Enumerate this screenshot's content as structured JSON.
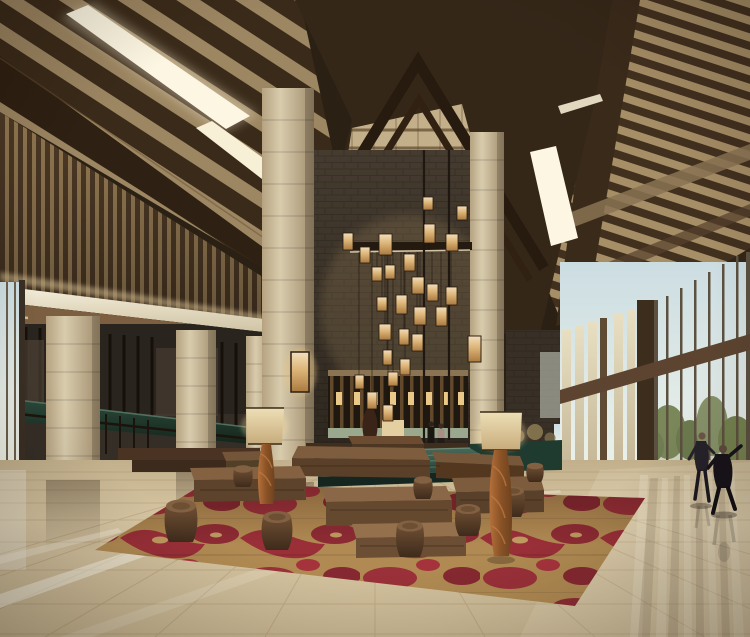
{
  "meta": {
    "kind": "photorealistic architectural rendering",
    "subject": "Asian-style resort hotel lobby interior with vaulted timber roof",
    "width_px": 750,
    "height_px": 637
  },
  "palette": {
    "wood-dark": "#2b2014",
    "wood-beam": "#3a2a19",
    "ceiling-tan": "#a68e66",
    "vault-tan": "#c3b08a",
    "skylight-white": "#fcf6e2",
    "fascia-cream": "#f2ecd8",
    "column-beige": "#d6caab",
    "stone-grey": "#453b2f",
    "marble-green": "#1f3b30",
    "water-teal": "#3d5d4c",
    "lantern-amber": "#e9c785",
    "floor-beige": "#d5c4a1",
    "carpet-red": "#9a2f38",
    "carpet-tan": "#b08a52",
    "bench-walnut": "#6d4e35",
    "sky-pale": "#cfdfе3",
    "tree-green": "#75824f",
    "lawn-green": "#b7c290",
    "figure-dark": "#211d24"
  },
  "scene": {
    "ceiling": {
      "label": "vaulted dark-timber ceiling with rafters and linear skylights"
    },
    "vault": {
      "label": "central gabled atrium vault with chevron beams"
    },
    "skylights": {
      "label": "glowing linear skylight strips",
      "count": 5
    },
    "slat_wall": {
      "label": "vertical wood slat clerestory wall, left wing"
    },
    "chandelier": {
      "label": "cascading cluster of amber box-lantern pendants",
      "lantern_count": 26
    },
    "columns": {
      "label": "beige stone-clad structural columns",
      "count": 5
    },
    "colonnade": {
      "label": "left colonnade with reception counter, railings and steps"
    },
    "screen_wall": {
      "label": "backlit bronze fin feature wall behind lobby desk"
    },
    "water_feature": {
      "label": "green marble reflecting pool / planter"
    },
    "seating": {
      "label": "cluster of rustic timber block benches and drum stools",
      "bench_count": 8,
      "stool_count": 8
    },
    "carpet": {
      "label": "red and gold abstract-pattern area rug"
    },
    "floor": {
      "label": "polished beige travertine floor with mirror reflections"
    },
    "window_wall": {
      "label": "floor-to-ceiling glazed wall with garden view",
      "view": "trees, lawn and pale sky"
    },
    "people": {
      "label": "two guests practicing tai chi by the windows",
      "count": 2
    },
    "staff": {
      "label": "two small figures at the lobby desk",
      "count": 2
    },
    "floor_lamps": {
      "label": "pair of floor lamps with twisted driftwood bases",
      "count": 2
    }
  }
}
